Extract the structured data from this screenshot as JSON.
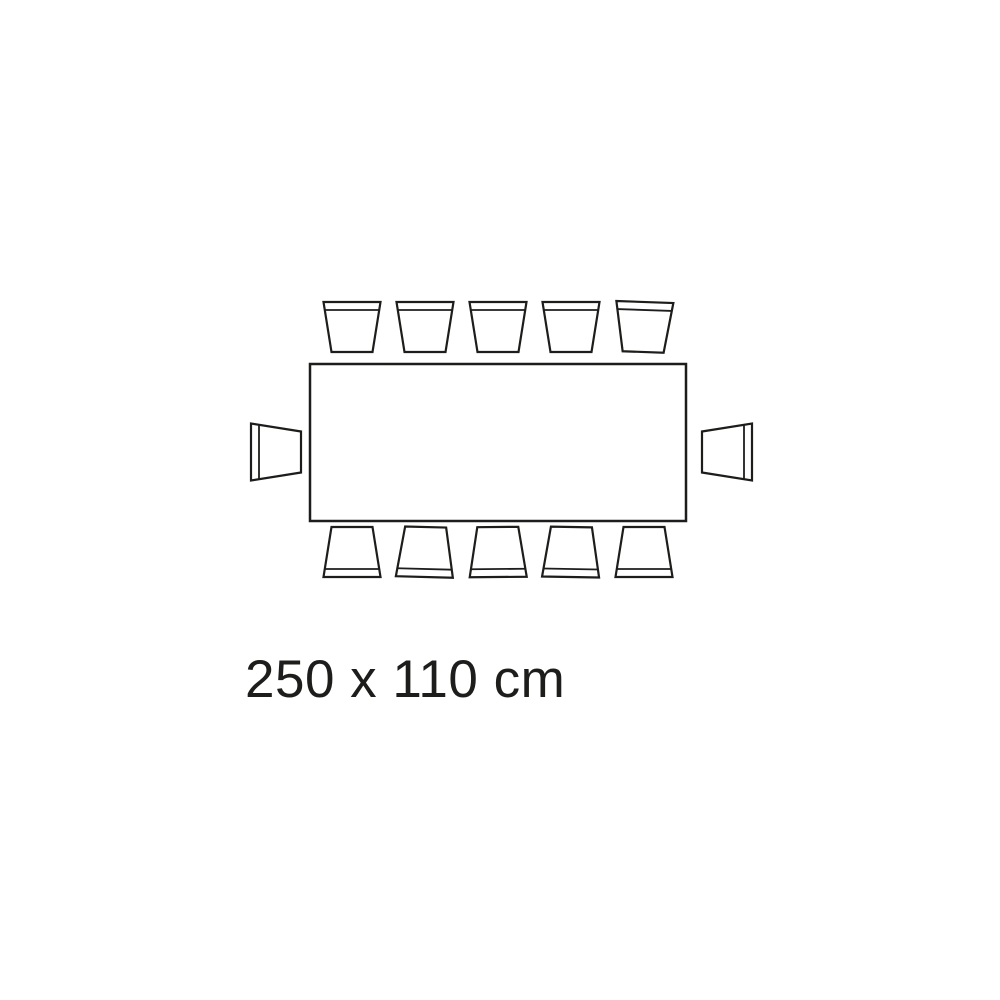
{
  "diagram": {
    "type": "table-seating-plan",
    "label": "250 x 110 cm",
    "table": {
      "shape": "rectangle",
      "width_cm": 250,
      "depth_cm": 110
    },
    "seats": {
      "top": 5,
      "bottom": 5,
      "left": 1,
      "right": 1,
      "total": 12
    },
    "colors": {
      "stroke": "#1d1d1b",
      "background": "#ffffff"
    }
  }
}
